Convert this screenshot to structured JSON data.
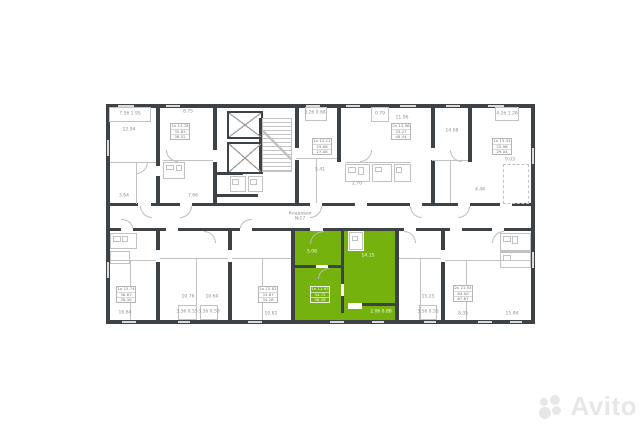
{
  "colors": {
    "bg": "#ffffff",
    "wall": "#3d4247",
    "lite": "#c2c2c2",
    "win": "#dcdcdc",
    "green": "#76b20e",
    "text": "#8f8f8f",
    "watermark": "#e7e7e7"
  },
  "watermark": {
    "text": "Avito"
  },
  "highlighted_unit": {
    "color": "#76b20e",
    "stat_rows": [
      "1к 11.93",
      "34.72",
      "36.28"
    ]
  },
  "plan": {
    "greens": [
      [
        295,
        231,
        100,
        90
      ]
    ],
    "walls": [
      [
        106,
        104,
        429,
        4
      ],
      [
        106,
        104,
        4,
        220
      ],
      [
        531,
        104,
        4,
        220
      ],
      [
        106,
        320,
        429,
        4
      ],
      [
        156,
        104,
        4,
        62
      ],
      [
        156,
        176,
        4,
        30
      ],
      [
        213,
        104,
        4,
        102
      ],
      [
        295,
        104,
        4,
        102
      ],
      [
        337,
        104,
        4,
        58
      ],
      [
        431,
        104,
        4,
        102
      ],
      [
        468,
        104,
        4,
        58
      ],
      [
        213,
        172,
        30,
        3
      ],
      [
        213,
        194,
        45,
        3
      ],
      [
        259,
        118,
        3,
        54
      ],
      [
        106,
        203,
        429,
        3
      ],
      [
        106,
        228,
        429,
        3
      ],
      [
        156,
        231,
        4,
        90
      ],
      [
        228,
        231,
        4,
        90
      ],
      [
        291,
        231,
        4,
        90
      ],
      [
        395,
        231,
        4,
        90
      ],
      [
        441,
        231,
        4,
        90
      ],
      [
        341,
        231,
        3,
        38
      ],
      [
        295,
        265,
        49,
        3
      ],
      [
        341,
        265,
        3,
        48
      ],
      [
        360,
        303,
        38,
        3
      ]
    ],
    "whites": [
      [
        138,
        203,
        13,
        3
      ],
      [
        180,
        203,
        12,
        3
      ],
      [
        310,
        203,
        12,
        3
      ],
      [
        355,
        203,
        12,
        3
      ],
      [
        410,
        203,
        12,
        3
      ],
      [
        458,
        203,
        12,
        3
      ],
      [
        500,
        203,
        12,
        3
      ],
      [
        121,
        228,
        12,
        3
      ],
      [
        166,
        228,
        12,
        3
      ],
      [
        240,
        228,
        12,
        3
      ],
      [
        310,
        228,
        13,
        3
      ],
      [
        404,
        228,
        12,
        3
      ],
      [
        450,
        228,
        12,
        3
      ],
      [
        492,
        228,
        12,
        3
      ],
      [
        316,
        265,
        12,
        3
      ],
      [
        341,
        284,
        3,
        12
      ],
      [
        213,
        150,
        4,
        12
      ],
      [
        295,
        148,
        4,
        12
      ],
      [
        431,
        148,
        4,
        12
      ],
      [
        156,
        250,
        4,
        12
      ],
      [
        228,
        250,
        4,
        12
      ],
      [
        441,
        250,
        4,
        12
      ],
      [
        348,
        231,
        16,
        20
      ],
      [
        348,
        303,
        14,
        6
      ]
    ],
    "wins": [
      [
        118,
        105,
        16,
        2
      ],
      [
        166,
        105,
        14,
        2
      ],
      [
        306,
        105,
        14,
        2
      ],
      [
        346,
        105,
        14,
        2
      ],
      [
        400,
        105,
        16,
        2
      ],
      [
        446,
        105,
        14,
        2
      ],
      [
        488,
        105,
        16,
        2
      ],
      [
        122,
        321,
        14,
        2
      ],
      [
        178,
        321,
        12,
        2
      ],
      [
        248,
        321,
        14,
        2
      ],
      [
        330,
        321,
        14,
        2
      ],
      [
        372,
        321,
        12,
        2
      ],
      [
        424,
        321,
        12,
        2
      ],
      [
        478,
        321,
        14,
        2
      ],
      [
        510,
        321,
        12,
        2
      ],
      [
        107,
        140,
        2,
        16
      ],
      [
        107,
        262,
        2,
        16
      ],
      [
        532,
        148,
        2,
        16
      ],
      [
        532,
        252,
        2,
        16
      ]
    ],
    "lites": [
      [
        110,
        162,
        46,
        1
      ],
      [
        136,
        162,
        1,
        42
      ],
      [
        163,
        160,
        50,
        1
      ],
      [
        296,
        158,
        41,
        1
      ],
      [
        316,
        158,
        1,
        45
      ],
      [
        345,
        162,
        66,
        1
      ],
      [
        432,
        160,
        36,
        1
      ],
      [
        450,
        160,
        1,
        43
      ],
      [
        110,
        260,
        46,
        1
      ],
      [
        130,
        260,
        1,
        60
      ],
      [
        160,
        258,
        68,
        1
      ],
      [
        196,
        258,
        1,
        62
      ],
      [
        232,
        258,
        59,
        1
      ],
      [
        262,
        258,
        1,
        62
      ],
      [
        399,
        258,
        42,
        1
      ],
      [
        420,
        258,
        1,
        62
      ],
      [
        445,
        260,
        86,
        1
      ],
      [
        466,
        260,
        1,
        60
      ],
      [
        500,
        251,
        31,
        1
      ]
    ],
    "boxes": [
      [
        109,
        107,
        42,
        15
      ],
      [
        305,
        107,
        22,
        14
      ],
      [
        371,
        107,
        18,
        15
      ],
      [
        495,
        107,
        24,
        14
      ],
      [
        178,
        305,
        19,
        15
      ],
      [
        200,
        305,
        18,
        15
      ],
      [
        419,
        305,
        18,
        15
      ],
      [
        163,
        162,
        22,
        17
      ],
      [
        345,
        164,
        25,
        18
      ],
      [
        372,
        164,
        20,
        18
      ],
      [
        394,
        164,
        17,
        18
      ],
      [
        110,
        233,
        27,
        16
      ],
      [
        110,
        251,
        20,
        13
      ],
      [
        500,
        233,
        31,
        18
      ],
      [
        500,
        252,
        31,
        16
      ],
      [
        230,
        176,
        16,
        16
      ],
      [
        248,
        176,
        15,
        16
      ],
      [
        349,
        232,
        14,
        18
      ]
    ],
    "fixes": [
      [
        166,
        165,
        8,
        5
      ],
      [
        176,
        165,
        6,
        6
      ],
      [
        348,
        167,
        8,
        6
      ],
      [
        358,
        167,
        6,
        8
      ],
      [
        375,
        167,
        7,
        5
      ],
      [
        396,
        167,
        6,
        6
      ],
      [
        113,
        236,
        8,
        6
      ],
      [
        122,
        236,
        6,
        6
      ],
      [
        503,
        236,
        8,
        6
      ],
      [
        512,
        236,
        6,
        8
      ],
      [
        503,
        255,
        8,
        6
      ],
      [
        232,
        179,
        7,
        6
      ],
      [
        250,
        179,
        7,
        6
      ],
      [
        352,
        236,
        6,
        5
      ]
    ],
    "dashes": [
      [
        503,
        164,
        26,
        40
      ]
    ],
    "xboxes": [
      [
        227,
        111,
        36,
        28
      ],
      [
        227,
        142,
        36,
        32
      ]
    ],
    "hatches": [
      [
        262,
        118,
        30,
        54
      ]
    ],
    "arcs": [
      [
        140,
        206,
        12,
        12,
        "bl"
      ],
      [
        180,
        206,
        12,
        12,
        "br"
      ],
      [
        310,
        206,
        12,
        12,
        "br"
      ],
      [
        410,
        206,
        12,
        12,
        "bl"
      ],
      [
        458,
        206,
        12,
        12,
        "br"
      ],
      [
        121,
        219,
        12,
        9,
        "tr"
      ],
      [
        240,
        219,
        12,
        9,
        "tl"
      ],
      [
        310,
        231,
        14,
        13,
        "tl"
      ],
      [
        404,
        231,
        12,
        12,
        "tr"
      ],
      [
        492,
        231,
        12,
        12,
        "tl"
      ],
      [
        318,
        268,
        11,
        11,
        "tl"
      ],
      [
        166,
        150,
        12,
        12,
        "bl"
      ],
      [
        360,
        150,
        12,
        12,
        "br"
      ],
      [
        450,
        150,
        12,
        12,
        "bl"
      ],
      [
        204,
        231,
        12,
        12,
        "tr"
      ],
      [
        136,
        162,
        12,
        12,
        "br"
      ]
    ],
    "labels": [
      [
        130,
        114,
        "7.5б 1.95"
      ],
      [
        129,
        130,
        "12.94"
      ],
      [
        188,
        112,
        "8.75"
      ],
      [
        315,
        113,
        "3.2б 0.68"
      ],
      [
        380,
        114,
        "0.79"
      ],
      [
        507,
        114,
        "4.2б 1.28"
      ],
      [
        320,
        170,
        "5.41"
      ],
      [
        357,
        184,
        "2.70"
      ],
      [
        402,
        118,
        "11.96"
      ],
      [
        452,
        131,
        "14.68"
      ],
      [
        510,
        160,
        "9.03"
      ],
      [
        480,
        190,
        "4.48"
      ],
      [
        124,
        196,
        "3.64"
      ],
      [
        193,
        196,
        "7.66"
      ],
      [
        300,
        214,
        "Кладовая"
      ],
      [
        300,
        219,
        "№17"
      ],
      [
        125,
        313,
        "16.64"
      ],
      [
        188,
        297,
        "10.76"
      ],
      [
        212,
        297,
        "10.60"
      ],
      [
        271,
        314,
        "10.82"
      ],
      [
        187,
        312,
        "3.5б 0.55"
      ],
      [
        209,
        312,
        "3.5б 0.58"
      ],
      [
        428,
        297,
        "15.25"
      ],
      [
        428,
        312,
        "3.5б 0.55"
      ],
      [
        463,
        314,
        "8.35"
      ],
      [
        512,
        314,
        "15.84"
      ]
    ],
    "wlabels": [
      [
        312,
        252,
        "5.08"
      ],
      [
        368,
        256,
        "14.15"
      ],
      [
        381,
        312,
        "2.0б 0.88"
      ]
    ],
    "statboxes": [
      {
        "x": 170,
        "y": 123,
        "w": 20,
        "h": 17,
        "rows": [
          "1к 13.78",
          "35.83",
          "38.52"
        ]
      },
      {
        "x": 312,
        "y": 138,
        "w": 20,
        "h": 17,
        "rows": [
          "1к 12.11",
          "25.06",
          "27.06"
        ]
      },
      {
        "x": 391,
        "y": 123,
        "w": 20,
        "h": 17,
        "rows": [
          "2к 13.96",
          "33.27",
          "48.44"
        ]
      },
      {
        "x": 492,
        "y": 138,
        "w": 20,
        "h": 17,
        "rows": [
          "1к 13.35",
          "25.96",
          "29.04"
        ]
      },
      {
        "x": 116,
        "y": 286,
        "w": 20,
        "h": 17,
        "rows": [
          "1к 15.74",
          "36.87",
          "38.30"
        ]
      },
      {
        "x": 258,
        "y": 286,
        "w": 20,
        "h": 17,
        "rows": [
          "1к 15.82",
          "33.67",
          "34.26"
        ]
      },
      {
        "x": 310,
        "y": 286,
        "w": 20,
        "h": 17,
        "green": true,
        "rows": [
          "1к 11.93",
          "34.72",
          "36.28"
        ]
      },
      {
        "x": 453,
        "y": 285,
        "w": 20,
        "h": 17,
        "rows": [
          "2к 21.55",
          "64.00",
          "67.67"
        ]
      }
    ]
  }
}
